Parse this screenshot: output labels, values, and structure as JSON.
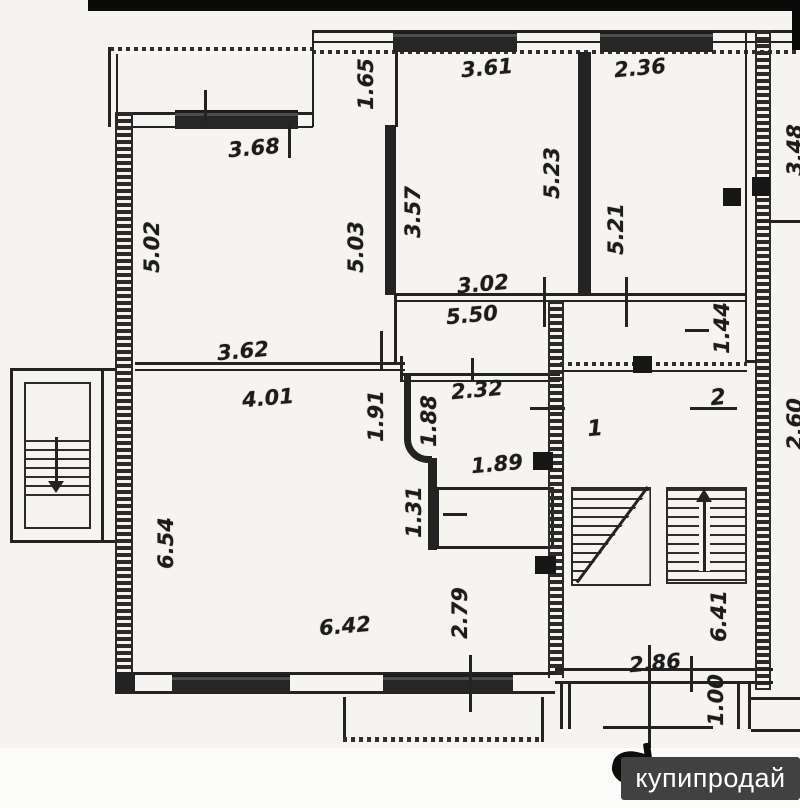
{
  "watermark": {
    "text": "купипродай"
  },
  "rooms": {
    "landing_number": "1",
    "unit_number": "2"
  },
  "dims": {
    "v1_65": "1.65",
    "v3_61": "3.61",
    "v2_36": "2.36",
    "v3_68": "3.68",
    "v5_02": "5.02",
    "v5_03": "5.03",
    "v3_57": "3.57",
    "v5_23": "5.23",
    "v5_21": "5.21",
    "v3_02": "3.02",
    "v5_50": "5.50",
    "v1_44": "1.44",
    "v3_62": "3.62",
    "v4_01": "4.01",
    "v2_32": "2.32",
    "v1_91": "1.91",
    "v1_88": "1.88",
    "v1_89": "1.89",
    "v1_31": "1.31",
    "v6_54": "6.54",
    "v6_42": "6.42",
    "v2_79": "2.79",
    "v6_41": "6.41",
    "v2_86": "2.86",
    "v1_00": "1.00",
    "cut_right_upper": "3.48",
    "cut_right_lower": "2.60"
  },
  "colors": {
    "ink": "#232323",
    "paper": "#f5f4f1",
    "watermark_bg": "#414141",
    "scan_bar": "#0a0a0a",
    "watermark_text": "#ffffff"
  }
}
